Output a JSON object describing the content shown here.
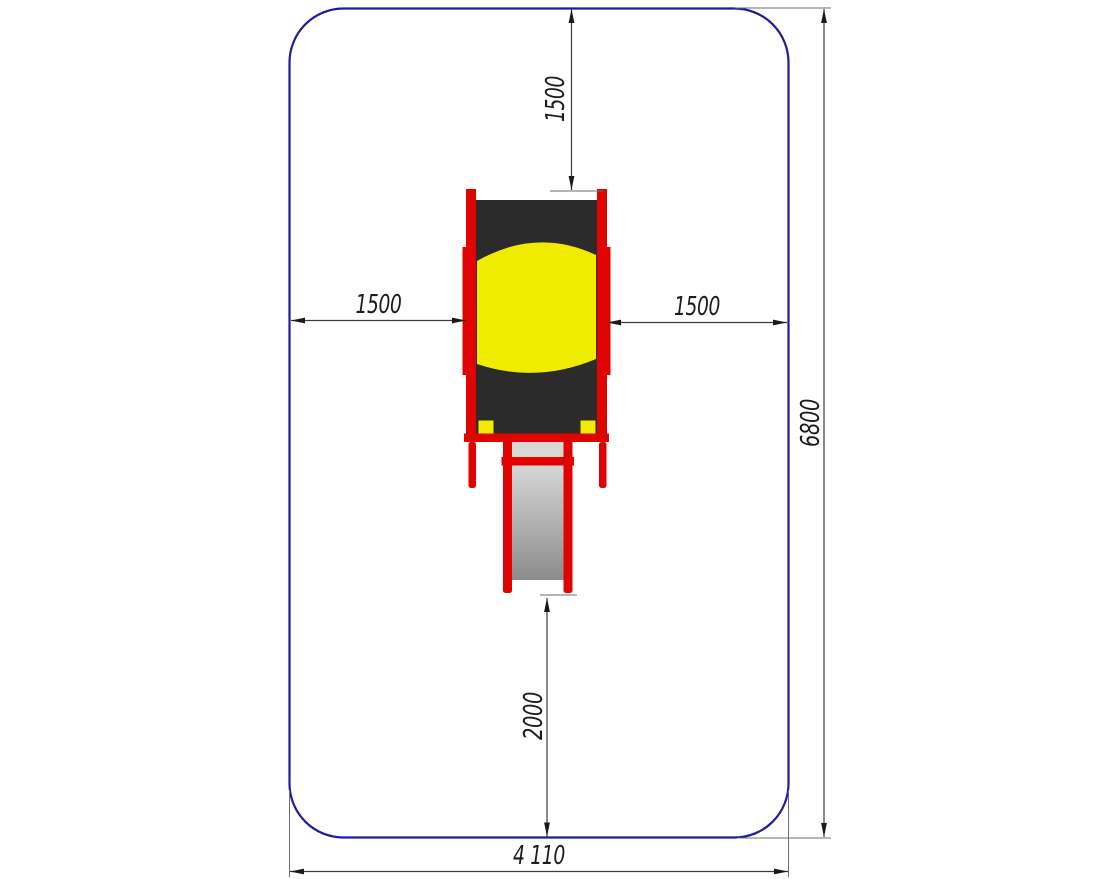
{
  "drawing": {
    "dimensions": {
      "top_clearance": "1500",
      "left_clearance": "1500",
      "right_clearance": "1500",
      "zone_height": "6800",
      "bottom_clearance": "2000",
      "zone_width": "4 110"
    },
    "colors": {
      "safety_zone_border": "#1c1e9b",
      "frame_red": "#e00400",
      "roof_yellow": "#f0ec00",
      "panel_dark": "#2b2b2b",
      "slide_gray_light": "#d8d8d8",
      "slide_gray_dark": "#8c8c8c",
      "dimension_line": "#3c3c3c",
      "text": "#1c1c1c",
      "background": "#ffffff"
    }
  }
}
